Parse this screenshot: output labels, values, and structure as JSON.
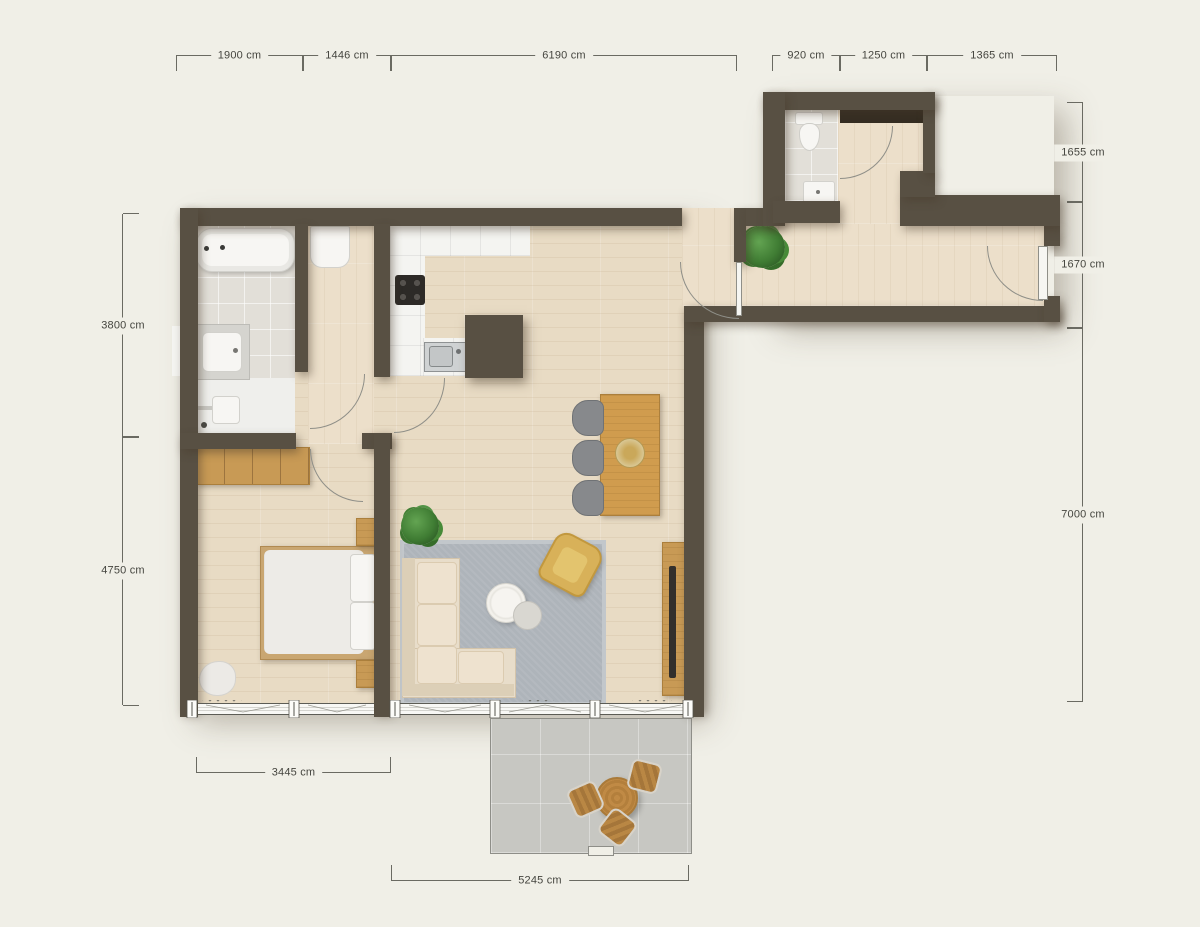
{
  "title": "apartment-floor-plan",
  "units": "cm",
  "dimensions": {
    "top_left": [
      "1900 cm",
      "1446 cm",
      "6190 cm"
    ],
    "top_right": [
      "920 cm",
      "1250 cm",
      "1365 cm"
    ],
    "left": [
      "3800 cm",
      "4750 cm"
    ],
    "right": [
      "1655 cm",
      "1670 cm",
      "7000 cm"
    ],
    "bottom": [
      "3445 cm",
      "5245 cm"
    ]
  },
  "rooms": [
    "bathroom",
    "hallway",
    "bedroom",
    "kitchen",
    "living-dining-room",
    "corridor",
    "wc",
    "entry",
    "terrace"
  ],
  "furniture": [
    "bathtub",
    "bathroom-sink",
    "shower",
    "washing-machine",
    "wardrobe",
    "double-bed",
    "nightstands",
    "pouf",
    "kitchen-counter",
    "cooktop",
    "kitchen-sink",
    "dining-table",
    "dining-chairs",
    "fruit-bowl",
    "area-rug",
    "sectional-sofa",
    "coffee-tables",
    "armchair",
    "tv-console",
    "tv",
    "plants",
    "wc-toilet",
    "wc-sink",
    "entry-closet",
    "terrace-table",
    "terrace-stools"
  ],
  "colors": {
    "background": "#f0efe7",
    "walls": "#585043",
    "wood_floor": "#e8dbc4",
    "tile_floor": "#e2dfd8",
    "marble_floor": "#f4f4f1",
    "terrace_floor": "#c7c7c2",
    "rug": "#aeb4ba",
    "sofa": "#e8ddca",
    "armchair": "#d8b159",
    "wood_furniture": "#c89a55",
    "plant_green": "#3f7c33"
  }
}
